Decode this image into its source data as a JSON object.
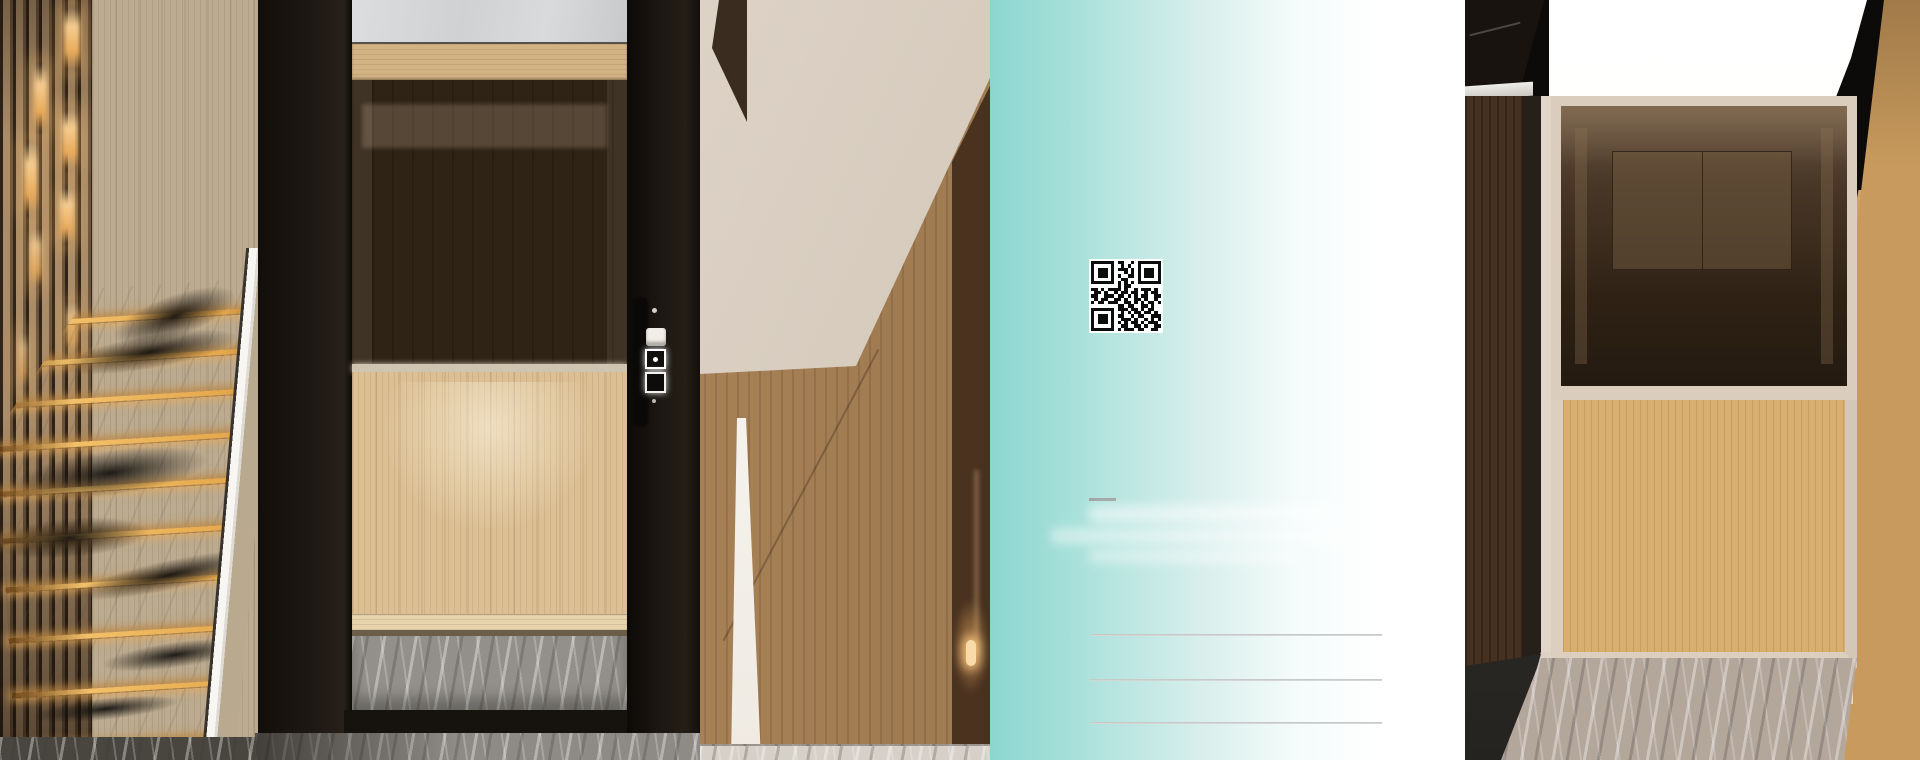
{
  "brochure_panel": {
    "qr_code": {
      "name": "qr-code",
      "modules": 21,
      "matrix": [
        "111111101100101111111",
        "100000100101001000001",
        "101110101110101011101",
        "101110100010101011101",
        "101110101001101011101",
        "100000100110001000001",
        "111111101010101111111",
        "000000001011000000000",
        "110101111010010111010",
        "011010010110110010110",
        "110011101101010110011",
        "010110011010011010010",
        "101101110011010101101",
        "000000001101100110100",
        "111111101110110101100",
        "100000100101011011010",
        "101110101100101100111",
        "101110100111010010101",
        "101110101010110101110",
        "100000100110011010011",
        "111111101011101100110"
      ]
    },
    "underline_dash": {
      "color": "#9EA4A3"
    },
    "contact_lines": {
      "count": 3,
      "color": "#C8CCCB"
    },
    "background": {
      "teal": "#8CD6CF",
      "white": "#FFFFFF"
    }
  },
  "left_photo": {
    "name": "staircase-and-home-lift",
    "colors": {
      "step_led_amber": "#E8A94F",
      "marble_white": "#F2EFE9",
      "frame_black": "#1A1511",
      "oak": "#D8BC8E"
    }
  },
  "right_photo": {
    "name": "lift-cabin-interior",
    "colors": {
      "ceiling_light": "#FCFCFB",
      "oak_wall": "#CDA066",
      "tinted_mirror": "#2F2114",
      "stone_floor": "#B2A69A"
    }
  }
}
